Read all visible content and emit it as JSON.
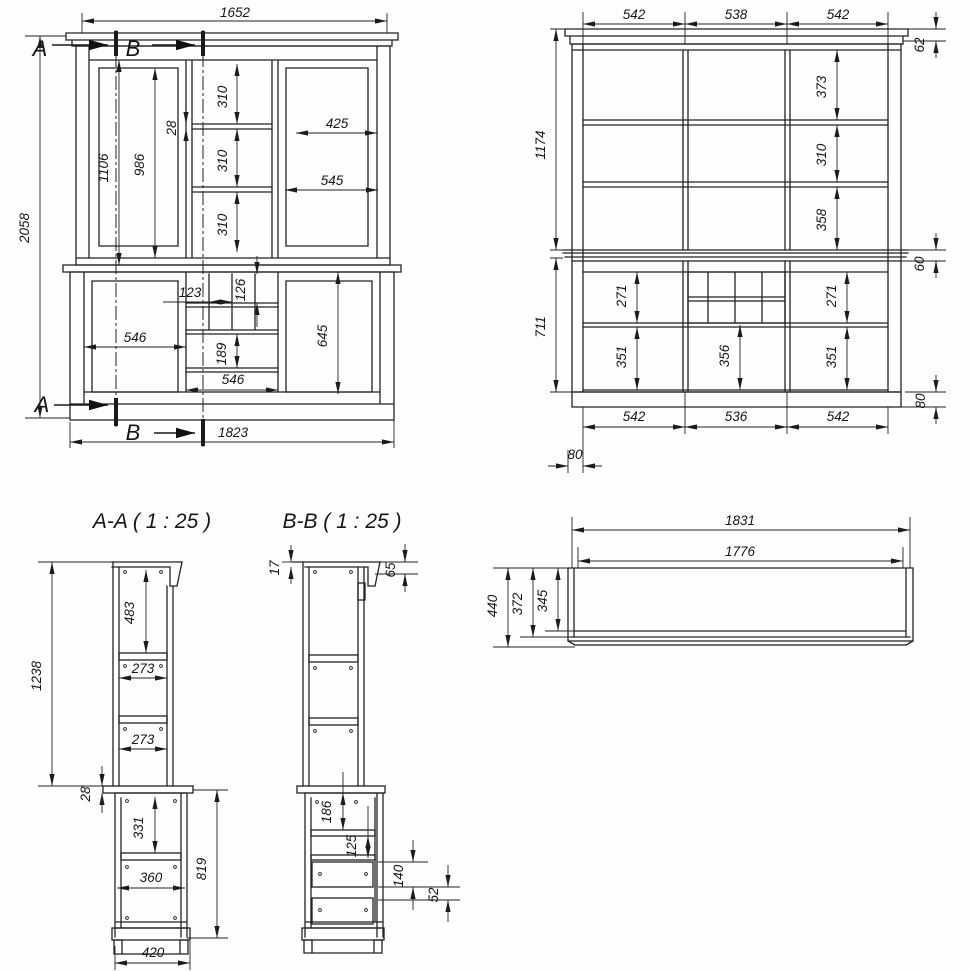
{
  "front": {
    "section_marker_a": "A",
    "section_marker_b": "B",
    "dims": {
      "overall_width": "1652",
      "overall_height": "2058",
      "upper_inner_height": "1106",
      "door_glass_height": "986",
      "shelf_thickness": "28",
      "shelf_bay_top": "310",
      "shelf_bay_mid": "310",
      "shelf_bay_bot": "310",
      "right_glass_width": "425",
      "right_door_width": "545",
      "cubby_width": "123",
      "cubby_height": "126",
      "left_door_width": "546",
      "drawer_height": "189",
      "drawer_width": "546",
      "lower_door_height": "645",
      "base_width": "1823"
    }
  },
  "rear": {
    "dims": {
      "top_bay_left": "542",
      "top_bay_mid": "538",
      "top_bay_right": "542",
      "cornice_height": "62",
      "upper_height": "1174",
      "bay_top": "373",
      "bay_mid": "310",
      "bay_bot": "358",
      "band_height": "60",
      "lower_height": "711",
      "niche_left": "271",
      "niche_right": "271",
      "door_left": "351",
      "niche_mid": "356",
      "door_right": "351",
      "plinth_height": "80",
      "bot_bay_left": "542",
      "bot_bay_mid": "536",
      "bot_bay_right": "542",
      "side_offset": "80"
    }
  },
  "section_aa": {
    "title": "A-A ( 1 : 25 )",
    "dims": {
      "upper_height": "1238",
      "top_clearance": "483",
      "shelf_depth_1": "273",
      "shelf_depth_2": "273",
      "worktop_thickness": "28",
      "lower_clearance": "331",
      "shelf_depth_3": "360",
      "lower_height": "819",
      "base_depth": "420"
    }
  },
  "section_bb": {
    "title": "B-B ( 1 : 25 )",
    "dims": {
      "top_panel": "17",
      "cornice_drop": "65",
      "niche_height": "186",
      "shelf_gap": "125",
      "drawer_front": "140",
      "drawer_gap": "52"
    }
  },
  "plan": {
    "dims": {
      "overall_width": "1831",
      "inner_width": "1776",
      "depth_overall": "440",
      "depth_mid": "372",
      "depth_inner": "345"
    }
  }
}
